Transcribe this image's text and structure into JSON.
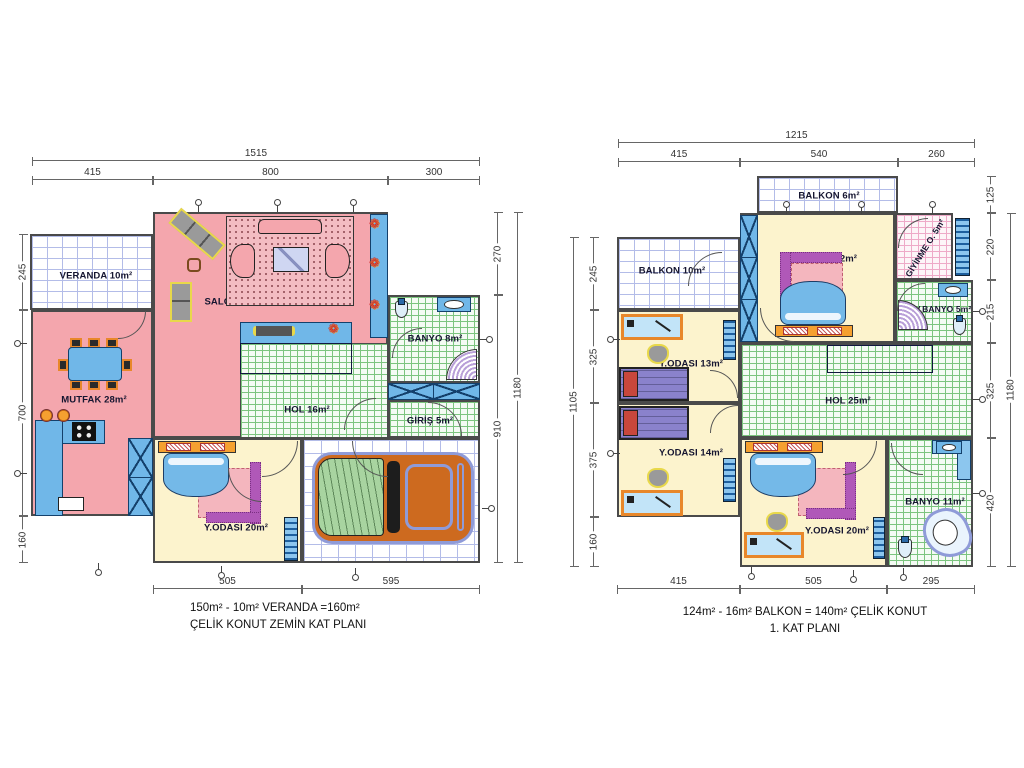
{
  "drawing_title": "ÇELİK KONUT floor plans",
  "colors": {
    "room_pink": "#f4a6ad",
    "room_cream": "#fcf3cd",
    "furniture_blue": "#70b7e8",
    "stair_blue": "#8b98d6",
    "wall": "#4a4a4a",
    "tile_green_line": "#7cc47f",
    "tile_lavender_line": "#b3bce8",
    "tile_pink_line": "#eeaac8",
    "accent_orange": "#f5a030",
    "car_orange": "#cd6a1f",
    "car_hood_green": "#a8d4a0",
    "rug_purple": "#b058b8"
  },
  "icons": {
    "plant_glyph": "❁"
  },
  "plans": [
    {
      "name": "zemin-kat",
      "caption1": "150m² - 10m² VERANDA  =160m²",
      "caption2": "ÇELİK KONUT  ZEMİN KAT PLANI",
      "rooms": [
        {
          "label": "VERANDA 10m²"
        },
        {
          "label": "SALON 43m²"
        },
        {
          "label": "MUTFAK 28m²"
        },
        {
          "label": "BANYO 8m²"
        },
        {
          "label": "HOL 16m²"
        },
        {
          "label": "GİRİŞ 5m²"
        },
        {
          "label": "Y.ODASI 20m²"
        },
        {
          "label": "GARAJ 23m²"
        }
      ],
      "dimensions": {
        "top_total": "1515",
        "top": [
          "415",
          "800",
          "300"
        ],
        "left": [
          "245",
          "700",
          "160"
        ],
        "right": [
          "270",
          "910"
        ],
        "right_total": "1180",
        "bottom": [
          "505",
          "595"
        ]
      }
    },
    {
      "name": "birinci-kat",
      "caption1": "124m² - 16m² BALKON = 140m² ÇELİK KONUT",
      "caption2": "1. KAT PLANI",
      "rooms": [
        {
          "label": "BALKON 6m²"
        },
        {
          "label": "BALKON 10m²"
        },
        {
          "label": "Y.ODASI 22m²"
        },
        {
          "label": "GİYİNME O. 5m²"
        },
        {
          "label": "EBV.BANYO 5m²"
        },
        {
          "label": "Y.ODASI 13m²"
        },
        {
          "label": "Y.ODASI 14m²"
        },
        {
          "label": "HOL 25m²"
        },
        {
          "label": "Y.ODASI 20m²"
        },
        {
          "label": "BANYO 11m²"
        }
      ],
      "dimensions": {
        "top_total": "1215",
        "top": [
          "415",
          "540",
          "260"
        ],
        "left_total": "1105",
        "left": [
          "245",
          "325",
          "375",
          "160"
        ],
        "right": [
          "125",
          "220",
          "215",
          "325",
          "420"
        ],
        "right_total": "1180",
        "bottom": [
          "415",
          "505",
          "295"
        ]
      }
    }
  ]
}
